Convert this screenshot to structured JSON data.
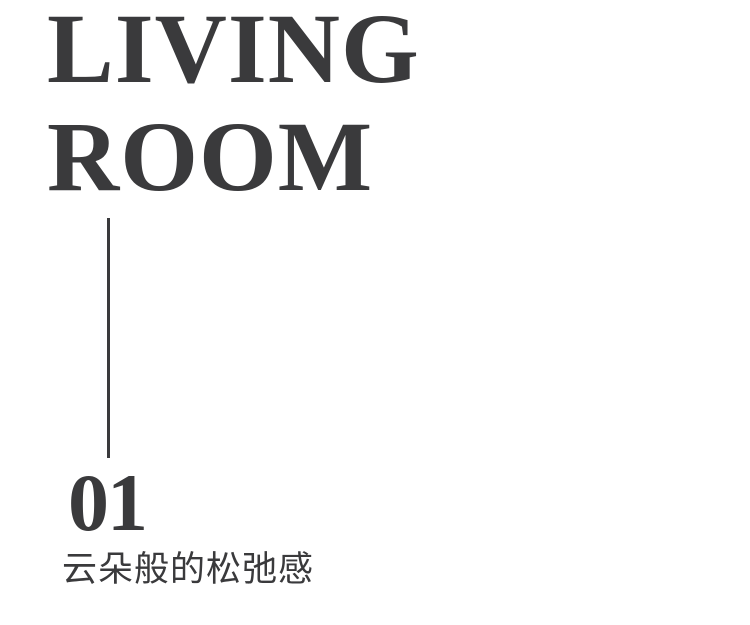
{
  "page": {
    "background_color": "#ffffff",
    "text_color": "#3a3a3c"
  },
  "poster": {
    "title": {
      "line1": "LIVING",
      "line2": "ROOM"
    },
    "divider": "vertical-line",
    "section_number": "01",
    "subtitle": "云朵般的松弛感"
  }
}
